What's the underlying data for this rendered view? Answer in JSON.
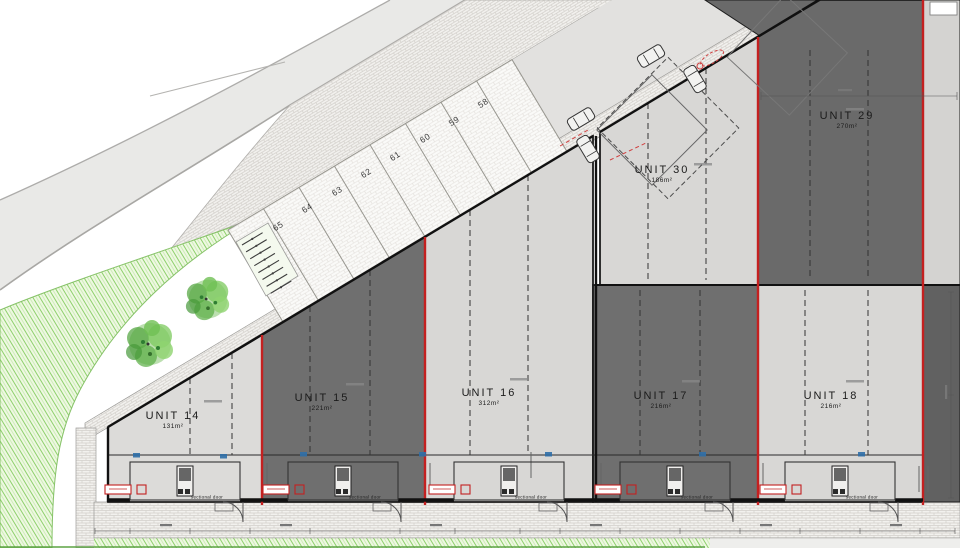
{
  "drawing": {
    "title": "site plan",
    "units": [
      {
        "name": "UNIT 14",
        "area": "131m²",
        "shade": "light"
      },
      {
        "name": "UNIT 15",
        "area": "221m²",
        "shade": "dark"
      },
      {
        "name": "UNIT 16",
        "area": "312m²",
        "shade": "light"
      },
      {
        "name": "UNIT 17",
        "area": "216m²",
        "shade": "dark"
      },
      {
        "name": "UNIT 18",
        "area": "216m²",
        "shade": "light"
      },
      {
        "name": "UNIT 29",
        "area": "270m²",
        "shade": "dark"
      },
      {
        "name": "UNIT 30",
        "area": "186m²",
        "shade": "light"
      }
    ],
    "parking": {
      "spaces": [
        "58",
        "59",
        "60",
        "61",
        "62",
        "63",
        "64",
        "65"
      ]
    },
    "labels": {
      "sectional_door": "sectional door"
    },
    "colors": {
      "boundary_red": "#c42020",
      "unit_dark": "#6f6f6f",
      "unit_light": "#d8d7d5",
      "landscape_green": "#9ed77e",
      "road_gray": "#e9e9e7",
      "marker_blue": "#2f6fa8"
    }
  }
}
